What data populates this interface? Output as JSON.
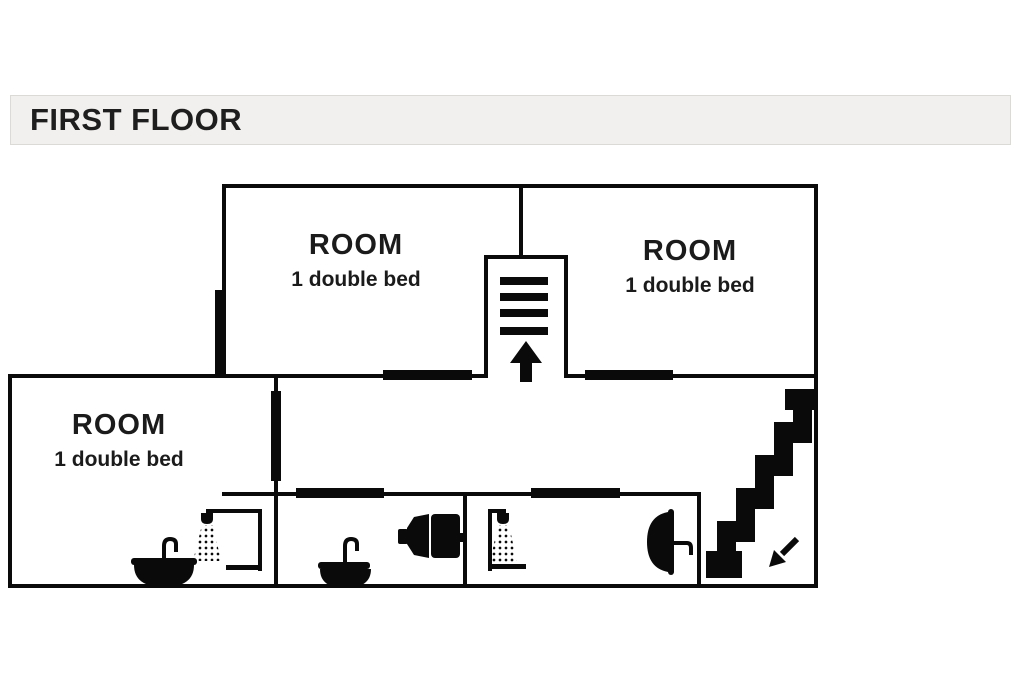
{
  "header": {
    "title": "FIRST FLOOR"
  },
  "plan": {
    "rooms": [
      {
        "id": "room-top-left",
        "label": "ROOM",
        "sublabel": "1 double bed"
      },
      {
        "id": "room-top-right",
        "label": "ROOM",
        "sublabel": "1 double bed"
      },
      {
        "id": "room-bottom-left",
        "label": "ROOM",
        "sublabel": "1 double bed"
      }
    ],
    "stairwell": {
      "icon": "arrow-up-icon",
      "step_bars": 4
    },
    "staircase_down": {
      "icon": "arrow-down-left-icon",
      "steps": 6
    },
    "bathroom_fixtures": [
      {
        "type": "sink",
        "location": "bottom-left-room"
      },
      {
        "type": "shower",
        "location": "bottom-left-room"
      },
      {
        "type": "sink",
        "location": "middle-bathroom"
      },
      {
        "type": "toilet",
        "location": "middle-bathroom"
      },
      {
        "type": "shower",
        "location": "right-bathroom"
      },
      {
        "type": "sink",
        "location": "right-bathroom"
      }
    ],
    "colors": {
      "wall": "#0a0a0a",
      "header_bg": "#f1f0ee",
      "page_bg": "#ffffff",
      "text": "#1b1b1b"
    }
  }
}
